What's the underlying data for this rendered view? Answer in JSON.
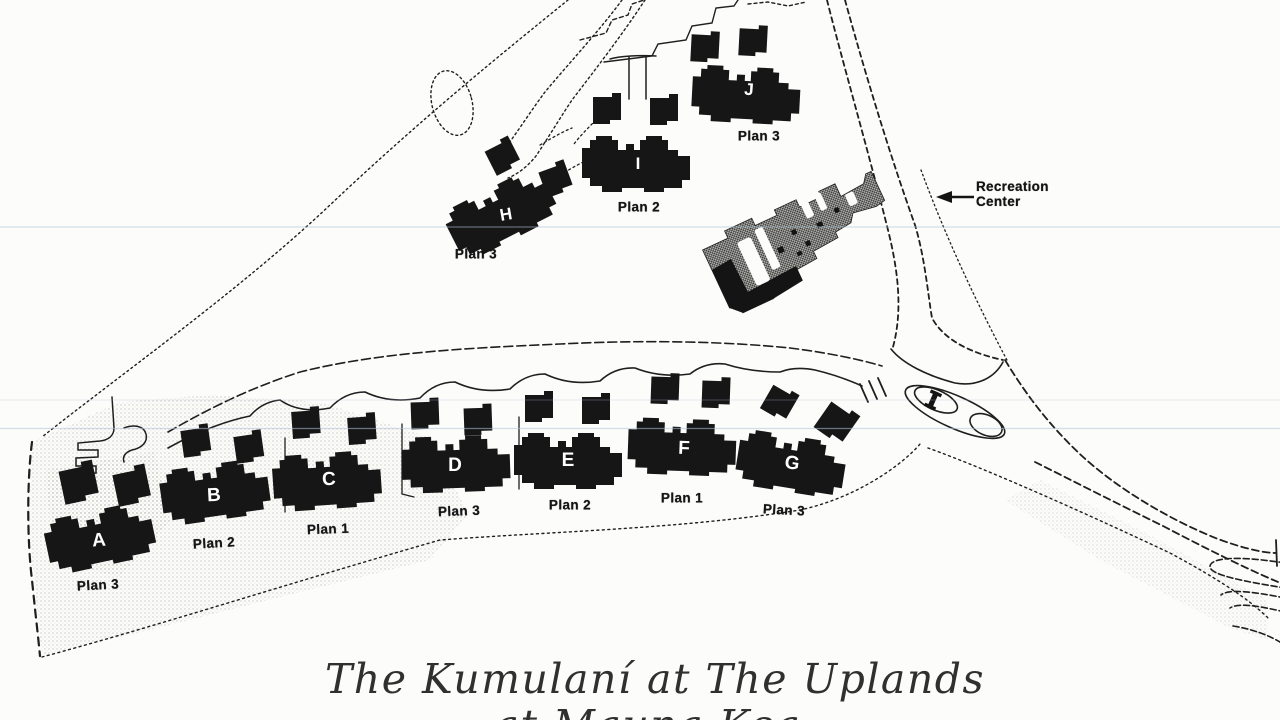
{
  "document": {
    "title_line1": "The Kumulaní at The Uplands",
    "title_line2": "at Mauna Kea"
  },
  "map": {
    "recreation_center": {
      "label_line1": "Recreation",
      "label_line2": "Center"
    },
    "buildings": [
      {
        "letter": "A",
        "plan": "Plan 3"
      },
      {
        "letter": "B",
        "plan": "Plan 2"
      },
      {
        "letter": "C",
        "plan": "Plan 1"
      },
      {
        "letter": "D",
        "plan": "Plan 3"
      },
      {
        "letter": "E",
        "plan": "Plan 2"
      },
      {
        "letter": "F",
        "plan": "Plan 1"
      },
      {
        "letter": "G",
        "plan": "Plan 3"
      },
      {
        "letter": "H",
        "plan": "Plan 3"
      },
      {
        "letter": "I",
        "plan": "Plan 2"
      },
      {
        "letter": "J",
        "plan": "Plan 3"
      }
    ],
    "colors": {
      "ink": "#1f1f1f",
      "paper": "#fcfcfa",
      "building_fill": "#161616",
      "recreation_gray": "#b3b3af",
      "scan_artifact_blue": "#aec4d8"
    }
  }
}
